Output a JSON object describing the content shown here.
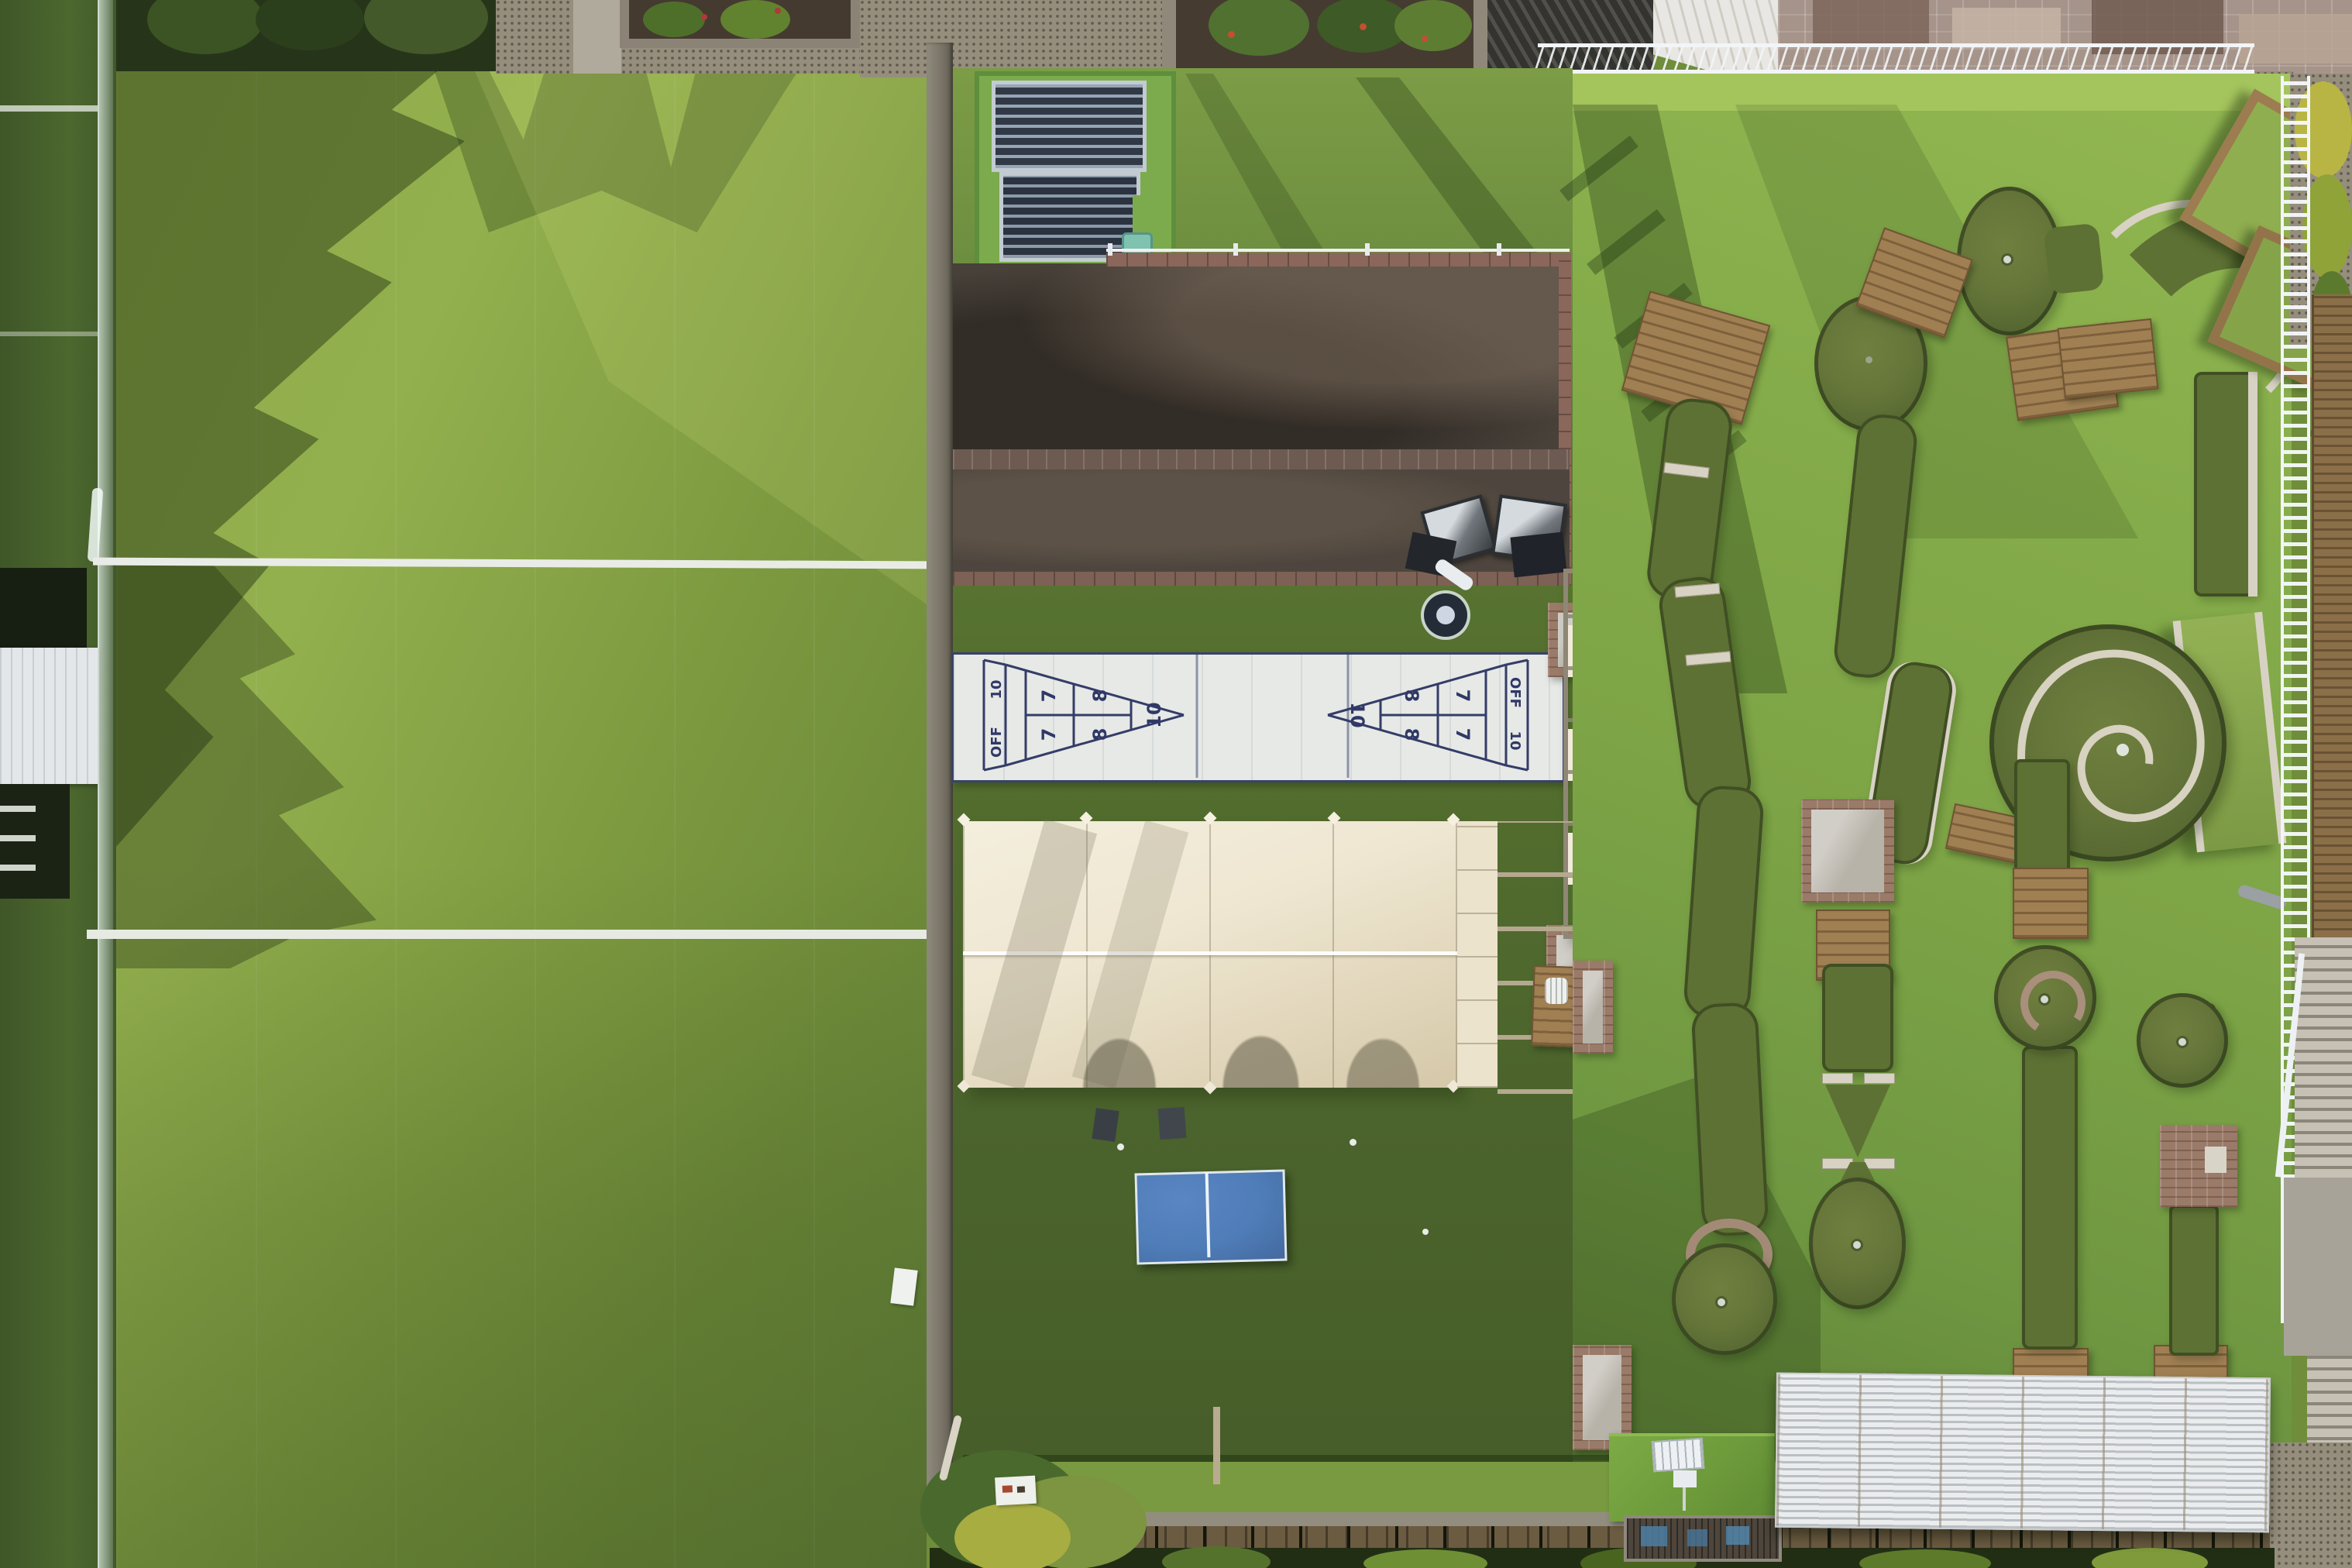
{
  "scene": {
    "description": "Aerial top-down drone view of a rooftop leisure complex: artificial-turf sports lawn (left), petanque courts, shuffleboard court, event tent, ping-pong table (center), and a mini-golf course with wooden tee decks, a spiral hole and white pergola structures (right)."
  },
  "shuffleboard": {
    "left_court": {
      "apex": "10",
      "eight_top": "8",
      "eight_bottom": "8",
      "seven_top": "7",
      "seven_bottom": "7",
      "base_top": "10",
      "base_bottom": "OFF"
    },
    "right_court": {
      "apex": "10",
      "eight_top": "8",
      "eight_bottom": "8",
      "seven_top": "7",
      "seven_bottom": "7",
      "base_top": "OFF",
      "base_bottom": "10"
    }
  },
  "colors": {
    "lawn_sunlit": "#93b04e",
    "lawn_shadow": "#5a7a33",
    "central_turf": "#55702f",
    "golf_turf": "#85ac4a",
    "golf_hole_surface": "#5e7134",
    "petanque_soil": "#48413a",
    "shuffleboard_white": "#e7e9e6",
    "shuffleboard_marking": "#323a66",
    "tent_canvas": "#efe7d2",
    "pergola_strap": "#f2ebdb",
    "wood_deck": "#a07f53",
    "ping_pong_blue": "#4f7db8",
    "white_roof": "#eaecee",
    "shed_roof_green": "#6f9b3c",
    "fence_white": "#f2f5f7",
    "brick": "#9a7a68"
  }
}
